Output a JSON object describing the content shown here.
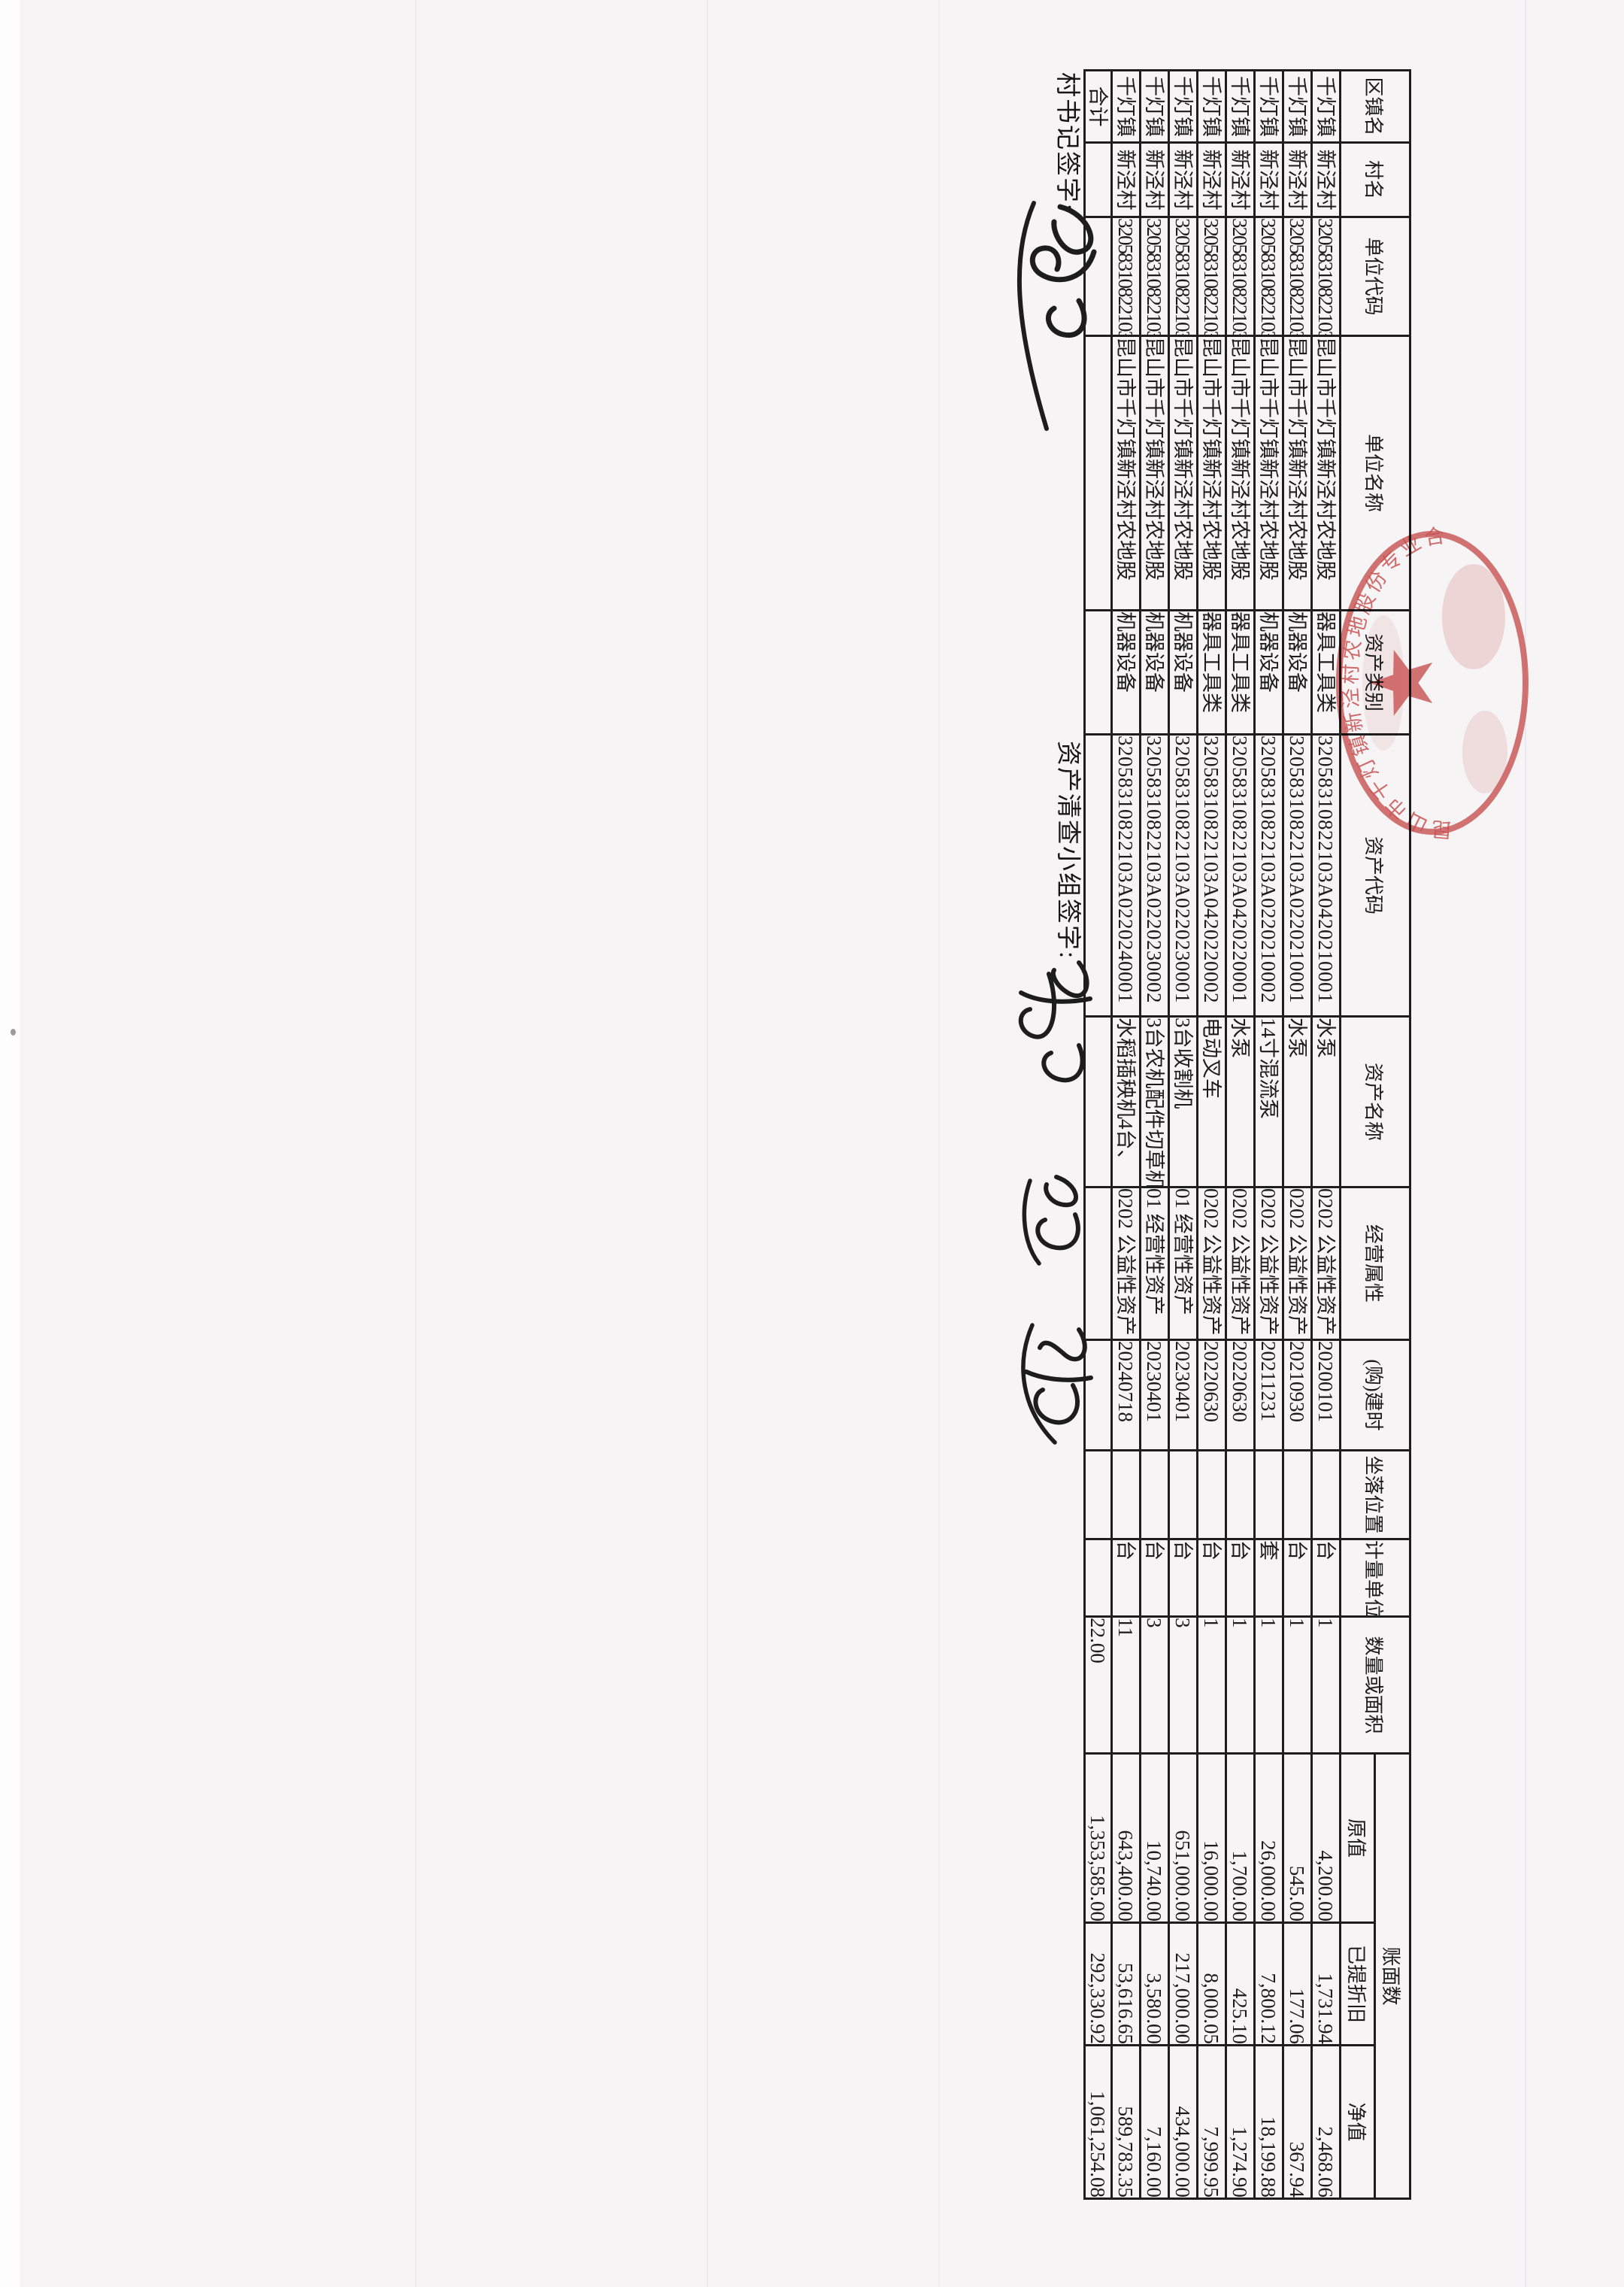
{
  "page": {
    "paper_color": "#f6f4f5",
    "ink_color": "#1c1c1c",
    "seal_color": "#c23a3a"
  },
  "signatures": {
    "village_secretary_label": "村书记签字:",
    "inventory_team_label": "资产清查小组签字:"
  },
  "seal": {
    "arc_text": "昆山市千灯镇新泾村农地股份专业合作社"
  },
  "table": {
    "headers": {
      "town": "区镇名",
      "village": "村名",
      "unit_code": "单位代码",
      "unit_name": "单位名称",
      "category": "资产类别",
      "asset_code": "资产代码",
      "asset_name": "资产名称",
      "attribute": "经营属性",
      "build_date": "(购)建时",
      "location": "坐落位置",
      "unit": "计量单位",
      "quantity": "数量或面积",
      "book_value_group": "账面数",
      "original_value": "原值",
      "depreciation": "已提折旧",
      "net_value": "净值"
    },
    "rows": [
      {
        "town": "千灯镇",
        "village": "新泾村",
        "unit_code": "32058310822103",
        "unit_name": "昆山市千灯镇新泾村农地股",
        "category": "器具工具类",
        "asset_code": "32058310822103A0420210001",
        "asset_name": "水泵",
        "attribute": "0202 公益性资产",
        "build_date": "20200101",
        "location": "",
        "unit": "台",
        "quantity": "1",
        "original_value": "4,200.00",
        "depreciation": "1,731.94",
        "net_value": "2,468.06"
      },
      {
        "town": "千灯镇",
        "village": "新泾村",
        "unit_code": "32058310822103",
        "unit_name": "昆山市千灯镇新泾村农地股",
        "category": "机器设备",
        "asset_code": "32058310822103A0220210001",
        "asset_name": "水泵",
        "attribute": "0202 公益性资产",
        "build_date": "20210930",
        "location": "",
        "unit": "台",
        "quantity": "1",
        "original_value": "545.00",
        "depreciation": "177.06",
        "net_value": "367.94"
      },
      {
        "town": "千灯镇",
        "village": "新泾村",
        "unit_code": "32058310822103",
        "unit_name": "昆山市千灯镇新泾村农地股",
        "category": "机器设备",
        "asset_code": "32058310822103A0220210002",
        "asset_name": "14寸混流泵",
        "attribute": "0202 公益性资产",
        "build_date": "20211231",
        "location": "",
        "unit": "套",
        "quantity": "1",
        "original_value": "26,000.00",
        "depreciation": "7,800.12",
        "net_value": "18,199.88"
      },
      {
        "town": "千灯镇",
        "village": "新泾村",
        "unit_code": "32058310822103",
        "unit_name": "昆山市千灯镇新泾村农地股",
        "category": "器具工具类",
        "asset_code": "32058310822103A0420220001",
        "asset_name": "水泵",
        "attribute": "0202 公益性资产",
        "build_date": "20220630",
        "location": "",
        "unit": "台",
        "quantity": "1",
        "original_value": "1,700.00",
        "depreciation": "425.10",
        "net_value": "1,274.90"
      },
      {
        "town": "千灯镇",
        "village": "新泾村",
        "unit_code": "32058310822103",
        "unit_name": "昆山市千灯镇新泾村农地股",
        "category": "器具工具类",
        "asset_code": "32058310822103A0420220002",
        "asset_name": "电动叉车",
        "attribute": "0202 公益性资产",
        "build_date": "20220630",
        "location": "",
        "unit": "台",
        "quantity": "1",
        "original_value": "16,000.00",
        "depreciation": "8,000.05",
        "net_value": "7,999.95"
      },
      {
        "town": "千灯镇",
        "village": "新泾村",
        "unit_code": "32058310822103",
        "unit_name": "昆山市千灯镇新泾村农地股",
        "category": "机器设备",
        "asset_code": "32058310822103A0220230001",
        "asset_name": "3台收割机",
        "attribute": "01 经营性资产",
        "build_date": "20230401",
        "location": "",
        "unit": "台",
        "quantity": "3",
        "original_value": "651,000.00",
        "depreciation": "217,000.00",
        "net_value": "434,000.00"
      },
      {
        "town": "千灯镇",
        "village": "新泾村",
        "unit_code": "32058310822103",
        "unit_name": "昆山市千灯镇新泾村农地股",
        "category": "机器设备",
        "asset_code": "32058310822103A0220230002",
        "asset_name": "3台农机配件切草机",
        "attribute": "01 经营性资产",
        "build_date": "20230401",
        "location": "",
        "unit": "台",
        "quantity": "3",
        "original_value": "10,740.00",
        "depreciation": "3,580.00",
        "net_value": "7,160.00"
      },
      {
        "town": "千灯镇",
        "village": "新泾村",
        "unit_code": "32058310822103",
        "unit_name": "昆山市千灯镇新泾村农地股",
        "category": "机器设备",
        "asset_code": "32058310822103A0220240001",
        "asset_name": "水稻插秧机4台、",
        "attribute": "0202 公益性资产",
        "build_date": "20240718",
        "location": "",
        "unit": "台",
        "quantity": "11",
        "original_value": "643,400.00",
        "depreciation": "53,616.65",
        "net_value": "589,783.35"
      }
    ],
    "total_row": {
      "label": "合计",
      "quantity": "22.00",
      "original_value": "1,353,585.00",
      "depreciation": "292,330.92",
      "net_value": "1,061,254.08"
    }
  }
}
